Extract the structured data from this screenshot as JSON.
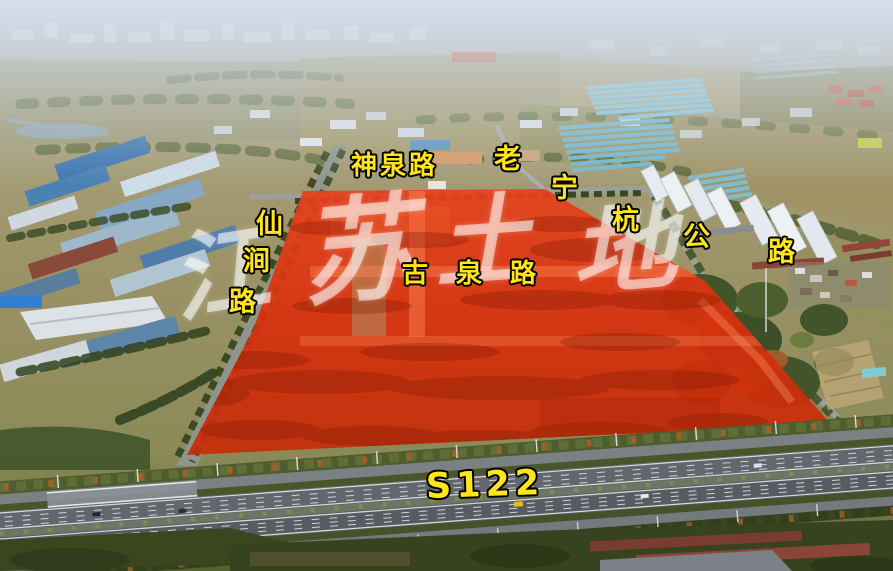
{
  "road_labels": {
    "shenquan": "神泉路",
    "laoninghang": {
      "text": "老宁杭公路",
      "chars": [
        "老",
        "宁",
        "杭",
        "公",
        "路"
      ]
    },
    "xianjian": {
      "text": "仙涧路",
      "chars": [
        "仙",
        "涧",
        "路"
      ]
    },
    "guquan": "古泉路",
    "s122": "S122"
  },
  "watermark": {
    "text": "江苏土地",
    "chars": [
      "江",
      "苏",
      "土",
      "地"
    ],
    "color": "#ffffff"
  },
  "colors": {
    "road_label": "#ffe51a",
    "road_label_outline": "#000000",
    "parcel_overlay": "#dd3310",
    "highway_asphalt": "#5c6066"
  }
}
